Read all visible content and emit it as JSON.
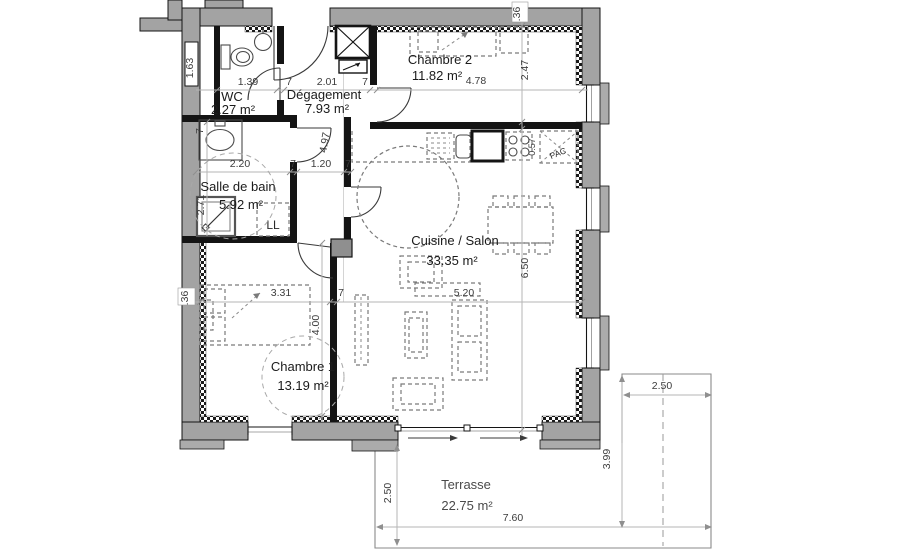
{
  "rooms": [
    {
      "name": "WC",
      "area": "2.27 m²"
    },
    {
      "name": "Dégagement",
      "area": "7.93 m²"
    },
    {
      "name": "Chambre 2",
      "area": "11.82 m²"
    },
    {
      "name": "Salle de bain",
      "area": "5.92 m²"
    },
    {
      "name": "Cuisine / Salon",
      "area": "33.35 m²"
    },
    {
      "name": "Chambre 1",
      "area": "13.19 m²"
    },
    {
      "name": "Terrasse",
      "area": "22.75 m²"
    }
  ],
  "appliances": {
    "washing_machine": "LL",
    "heat_pump": "PAC"
  },
  "dims": {
    "wc_width": "1.39",
    "wall_a": "7",
    "hall_width": "2.01",
    "wall_b": "7",
    "ch2_width": "4.78",
    "ch2_depth": "2.47",
    "top_wall_thickness": ".36",
    "left_wall_thickness": ".36",
    "wc_height": "1.63",
    "bath_width": "2.20",
    "wall_c": "7",
    "hall_corridor_width": "1.20",
    "wall_d": "7",
    "bath_wall_thickness": "7",
    "bath_height": "2.71",
    "hall_length": "4.97",
    "ch1_width": "3.31",
    "wall_e": "7",
    "salon_width": "5.20",
    "ch1_height": "4.00",
    "salon_height": "6.50",
    "counter_depth": "0.57",
    "terrace_left_height": "2.50",
    "terrace_width": "7.60",
    "terrace_right_height": "3.99",
    "terrace_right_width": "2.50"
  },
  "colors": {
    "exterior_wall": "#a3a3a3",
    "interior_wall": "#141414",
    "dimension_text": "#3c3c3c",
    "furniture": "#7a7a7a"
  }
}
